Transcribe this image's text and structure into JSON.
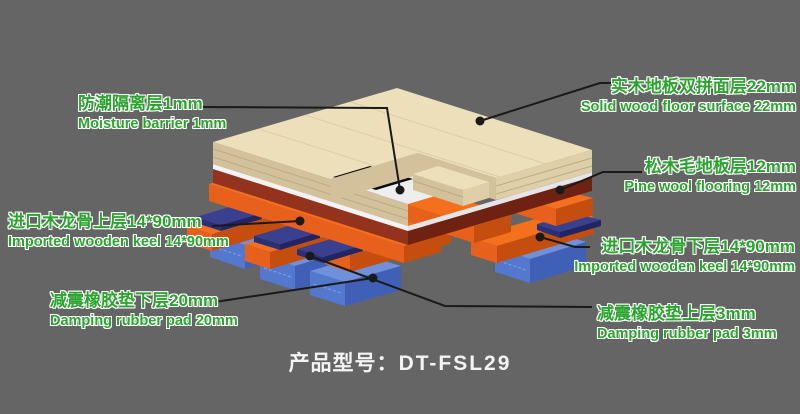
{
  "product": {
    "model_label": "产品型号：",
    "model": "DT-FSL29"
  },
  "labels": [
    {
      "id": "solid-wood-surface",
      "zh": "实木地板双拼面层22mm",
      "en": "Solid wood floor surface 22mm"
    },
    {
      "id": "moisture-barrier",
      "zh": "防潮隔离层1mm",
      "en": "Moisture barrier 1mm"
    },
    {
      "id": "pine-flooring",
      "zh": "松木毛地板层12mm",
      "en": "Pine wool flooring 12mm"
    },
    {
      "id": "keel-upper",
      "zh": "进口木龙骨上层14*90mm",
      "en": "Imported wooden keel 14*90mm"
    },
    {
      "id": "keel-lower",
      "zh": "进口木龙骨下层14*90mm",
      "en": "Imported wooden keel 14*90mm"
    },
    {
      "id": "damper-lower",
      "zh": "减震橡胶垫下层20mm",
      "en": "Damping rubber pad 20mm"
    },
    {
      "id": "damper-upper",
      "zh": "减震橡胶垫上层3mm",
      "en": "Damping rubber pad 3mm"
    }
  ],
  "colors": {
    "background": "#656565",
    "label_green": "#2ba32f",
    "title_white": "#f4f4f4",
    "callout_black": "#1a1a1a",
    "wood_surface": "#ecdfba",
    "moisture_barrier_white": "#eceef0",
    "pine_subfloor_maroon": "#93331d",
    "keel_orange": "#e8611c",
    "rubber_pad_blue": "#5478cd",
    "rubber_pad_navy": "#2b3076",
    "cutaway_shadow": "#0c0c0c"
  }
}
